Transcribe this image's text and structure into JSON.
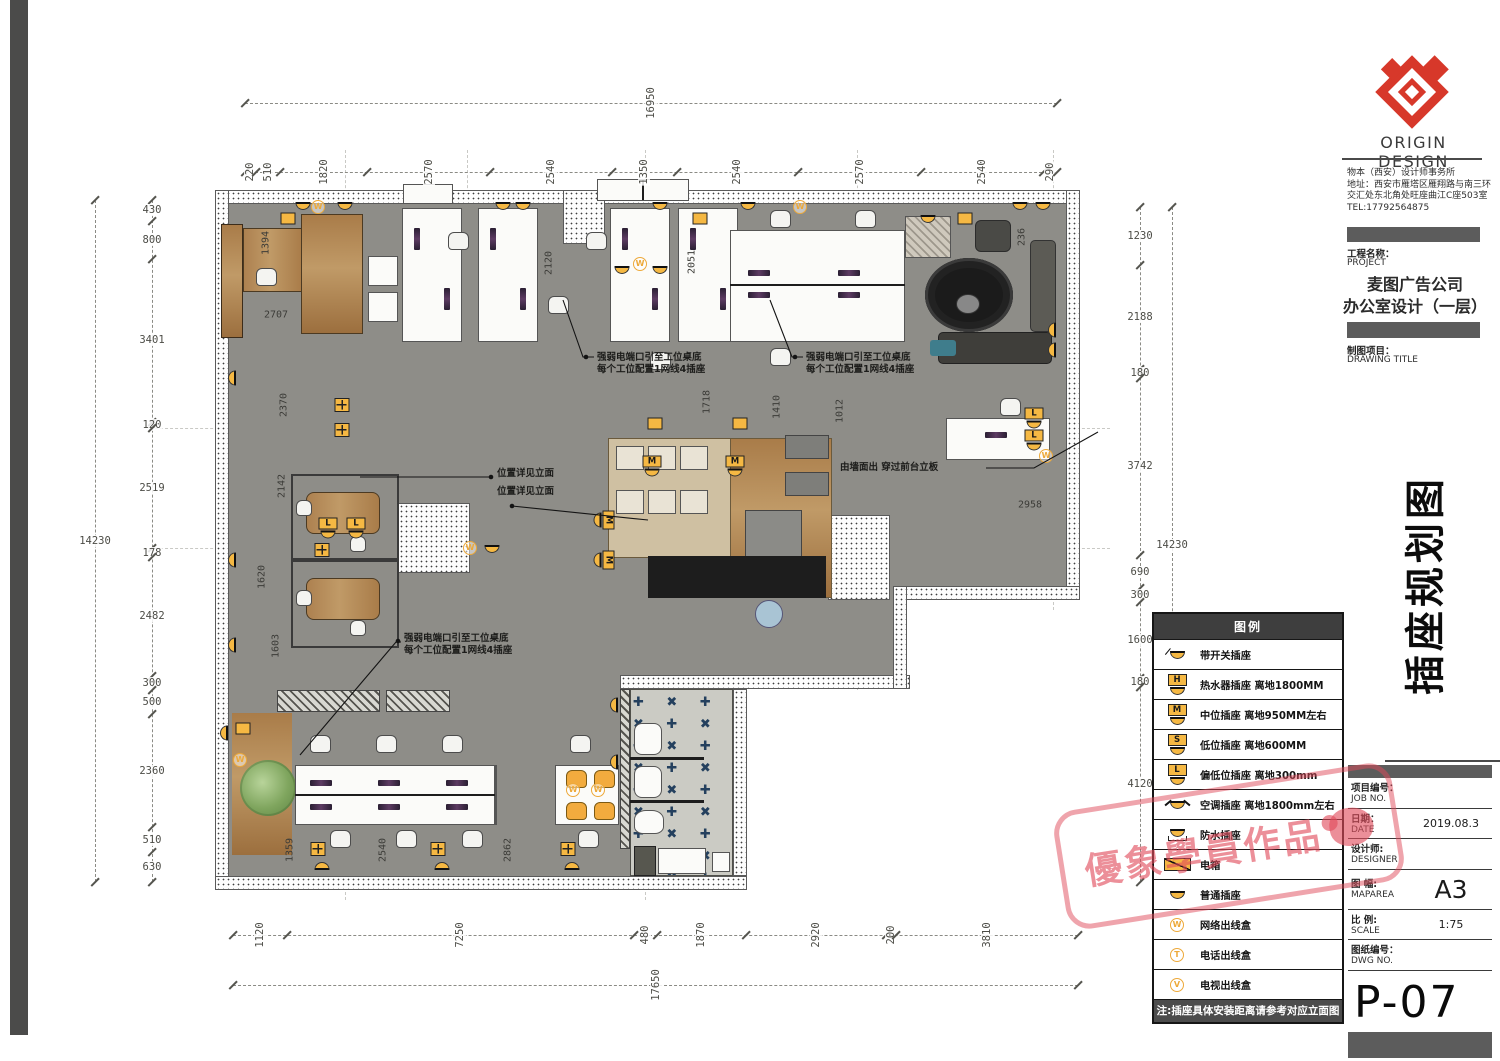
{
  "title_block": {
    "brand": "ORIGIN DESIGN",
    "company_lines": [
      "物本（西安）设计师事务所",
      "地址：西安市雁塔区雁翔路与南三环",
      "交汇处东北角处旺座曲江C座503室",
      "TEL:17792564875"
    ],
    "project_label_cn": "工程名称：",
    "project_label_en": "PROJECT",
    "project_name1": "麦图广告公司",
    "project_name2": "办公室设计（一层）",
    "drawing_label_cn": "制图项目：",
    "drawing_label_en": "DRAWING TITLE",
    "side_title": "插座规划图",
    "info_rows": [
      {
        "cn": "项目编号：",
        "en": "JOB NO.",
        "value": "",
        "big": false
      },
      {
        "cn": "日期：",
        "en": "DATE",
        "value": "2019.08.3",
        "big": false
      },
      {
        "cn": "设计师:",
        "en": "DESIGNER",
        "value": "",
        "big": false
      },
      {
        "cn": "图 幅:",
        "en": "MAPAREA",
        "value": "A3",
        "big": true
      },
      {
        "cn": "比 例:",
        "en": "SCALE",
        "value": "1:75",
        "big": false
      },
      {
        "cn": "图纸编号：",
        "en": "DWG NO.",
        "value": "",
        "big": false
      }
    ],
    "dwg_no": "P-07"
  },
  "legend": {
    "header": "图例",
    "items": [
      {
        "t": "dome-sw",
        "letter": "",
        "label": "带开关插座"
      },
      {
        "t": "H",
        "letter": "H",
        "label": "热水器插座 离地1800MM"
      },
      {
        "t": "M",
        "letter": "M",
        "label": "中位插座 离地950MM左右"
      },
      {
        "t": "S",
        "letter": "S",
        "label": "低位插座 离地600MM"
      },
      {
        "t": "L",
        "letter": "L",
        "label": "偏低位插座 离地300mm"
      },
      {
        "t": "ac",
        "letter": "",
        "label": "空调插座 离地1800mm左右"
      },
      {
        "t": "wp",
        "letter": "",
        "label": "防水插座"
      },
      {
        "t": "ebox",
        "letter": "",
        "label": "电箱"
      },
      {
        "t": "dome",
        "letter": "",
        "label": "普通插座"
      },
      {
        "t": "W",
        "letter": "W",
        "label": "网络出线盒"
      },
      {
        "t": "T",
        "letter": "T",
        "label": "电话出线盒"
      },
      {
        "t": "V",
        "letter": "V",
        "label": "电视出线盒"
      }
    ],
    "note": "注:插座具体安装距离请参考对应立面图"
  },
  "watermark": {
    "text": "優象學員作品",
    "color": "#e04a5a"
  },
  "dimensions": {
    "chains": [
      {
        "o": "h",
        "x": 245,
        "y": 103,
        "len": 812,
        "values": [
          "16950"
        ]
      },
      {
        "o": "h",
        "x": 245,
        "y": 172,
        "len": 812,
        "values": [
          "220",
          "510",
          "1820",
          "2570",
          "2540",
          "1350",
          "2540",
          "2570",
          "2540",
          "290"
        ]
      },
      {
        "o": "v",
        "x": 95,
        "y": 200,
        "len": 682,
        "values": [
          "14230"
        ]
      },
      {
        "o": "v",
        "x": 152,
        "y": 200,
        "len": 682,
        "values": [
          "430",
          "800",
          "3401",
          "120",
          "2519",
          "178",
          "2482",
          "300",
          "500",
          "2360",
          "510",
          "630"
        ]
      },
      {
        "o": "v",
        "x": 1140,
        "y": 207,
        "len": 675,
        "values": [
          "1230",
          "2188",
          "180",
          "3742",
          "690",
          "300",
          "1600",
          "180",
          "4120"
        ]
      },
      {
        "o": "v",
        "x": 1172,
        "y": 207,
        "len": 675,
        "values": [
          "14230"
        ]
      },
      {
        "o": "h",
        "x": 233,
        "y": 935,
        "len": 845,
        "values": [
          "1120",
          "7250",
          "480",
          "1870",
          "2920",
          "200",
          "3810"
        ]
      },
      {
        "o": "h",
        "x": 233,
        "y": 985,
        "len": 845,
        "values": [
          "17650"
        ]
      }
    ],
    "interior": [
      {
        "v": "1394",
        "x": 266,
        "y": 243,
        "o": "v"
      },
      {
        "v": "2707",
        "x": 276,
        "y": 315,
        "o": "h"
      },
      {
        "v": "2370",
        "x": 284,
        "y": 405,
        "o": "v"
      },
      {
        "v": "2142",
        "x": 282,
        "y": 486,
        "o": "v"
      },
      {
        "v": "1620",
        "x": 262,
        "y": 577,
        "o": "v"
      },
      {
        "v": "1603",
        "x": 276,
        "y": 646,
        "o": "v"
      },
      {
        "v": "2120",
        "x": 549,
        "y": 263,
        "o": "v"
      },
      {
        "v": "2051",
        "x": 692,
        "y": 262,
        "o": "v"
      },
      {
        "v": "236",
        "x": 1022,
        "y": 237,
        "o": "v"
      },
      {
        "v": "1718",
        "x": 707,
        "y": 402,
        "o": "v"
      },
      {
        "v": "1410",
        "x": 777,
        "y": 407,
        "o": "v"
      },
      {
        "v": "1012",
        "x": 840,
        "y": 411,
        "o": "v"
      },
      {
        "v": "2958",
        "x": 1030,
        "y": 505,
        "o": "h"
      },
      {
        "v": "1359",
        "x": 290,
        "y": 850,
        "o": "v"
      },
      {
        "v": "2540",
        "x": 383,
        "y": 850,
        "o": "v"
      },
      {
        "v": "2862",
        "x": 508,
        "y": 850,
        "o": "v"
      }
    ]
  },
  "annotations": [
    {
      "x": 597,
      "y": 352,
      "lines": [
        "强弱电端口引至工位桌底",
        "每个工位配置1网线4插座"
      ]
    },
    {
      "x": 806,
      "y": 352,
      "lines": [
        "强弱电端口引至工位桌底",
        "每个工位配置1网线4插座"
      ]
    },
    {
      "x": 497,
      "y": 468,
      "lines": [
        "位置详见立面"
      ]
    },
    {
      "x": 497,
      "y": 486,
      "lines": [
        "位置详见立面"
      ]
    },
    {
      "x": 840,
      "y": 462,
      "lines": [
        "由墙面出 穿过前台立板"
      ]
    },
    {
      "x": 404,
      "y": 633,
      "lines": [
        "强弱电端口引至工位桌底",
        "每个工位配置1网线4插座"
      ]
    }
  ],
  "plan": {
    "tile_pattern": "✚ ✖ ✚ ✖ ✚ ✖ ✚ ✖ ✚ ✖ ✚ ✖ ✚ ✖ ✚ ✖ ✚ ✖ ✚ ✖ ✚ ✖ ✚ ✖ ✚ ✖ ✚ ✖ ✚ ✖ ✚ ✖ ✚ ✖ ✚ ✖ ✚ ✖ ✚ ✖ ✚ ✖ ✚ ✖ ✚ ✖ ✚ ✖ ✚ ✖",
    "sockets": [
      {
        "t": "dome",
        "x": 303,
        "y": 206,
        "r": 0
      },
      {
        "t": "dome",
        "x": 345,
        "y": 206,
        "r": 0
      },
      {
        "t": "box",
        "x": 288,
        "y": 219,
        "r": 0
      },
      {
        "t": "W",
        "x": 318,
        "y": 207,
        "r": 0
      },
      {
        "t": "dome",
        "x": 503,
        "y": 206,
        "r": 0
      },
      {
        "t": "dome",
        "x": 523,
        "y": 206,
        "r": 0
      },
      {
        "t": "dome",
        "x": 660,
        "y": 206,
        "r": 0
      },
      {
        "t": "box",
        "x": 700,
        "y": 219,
        "r": 0
      },
      {
        "t": "dome",
        "x": 748,
        "y": 206,
        "r": 0
      },
      {
        "t": "W",
        "x": 800,
        "y": 207,
        "r": 0
      },
      {
        "t": "dome",
        "x": 928,
        "y": 219,
        "r": 0
      },
      {
        "t": "box",
        "x": 965,
        "y": 219,
        "r": 0
      },
      {
        "t": "dome",
        "x": 1020,
        "y": 206,
        "r": 0
      },
      {
        "t": "dome",
        "x": 1043,
        "y": 206,
        "r": 0
      },
      {
        "t": "dome",
        "x": 622,
        "y": 270,
        "r": 0
      },
      {
        "t": "W",
        "x": 640,
        "y": 264,
        "r": 0
      },
      {
        "t": "dome",
        "x": 660,
        "y": 270,
        "r": 0
      },
      {
        "t": "dome",
        "x": 232,
        "y": 378,
        "r": 90
      },
      {
        "t": "dome",
        "x": 232,
        "y": 560,
        "r": 90
      },
      {
        "t": "dome",
        "x": 232,
        "y": 645,
        "r": 90
      },
      {
        "t": "fbox",
        "x": 342,
        "y": 405,
        "r": 0
      },
      {
        "t": "fbox",
        "x": 342,
        "y": 430,
        "r": 0
      },
      {
        "t": "L",
        "x": 328,
        "y": 528,
        "r": 0
      },
      {
        "t": "L",
        "x": 356,
        "y": 528,
        "r": 0
      },
      {
        "t": "fbox",
        "x": 322,
        "y": 550,
        "r": 0
      },
      {
        "t": "W",
        "x": 470,
        "y": 548,
        "r": 0
      },
      {
        "t": "dome",
        "x": 492,
        "y": 549,
        "r": 0
      },
      {
        "t": "box",
        "x": 655,
        "y": 424,
        "r": 0
      },
      {
        "t": "box",
        "x": 740,
        "y": 424,
        "r": 0
      },
      {
        "t": "M",
        "x": 652,
        "y": 466,
        "r": 0
      },
      {
        "t": "M",
        "x": 735,
        "y": 466,
        "r": 0
      },
      {
        "t": "M",
        "x": 604,
        "y": 520,
        "r": 90
      },
      {
        "t": "M",
        "x": 604,
        "y": 560,
        "r": 90
      },
      {
        "t": "L",
        "x": 1034,
        "y": 418,
        "r": 0
      },
      {
        "t": "L",
        "x": 1034,
        "y": 440,
        "r": 0
      },
      {
        "t": "W",
        "x": 1046,
        "y": 456,
        "r": 0
      },
      {
        "t": "dome",
        "x": 1052,
        "y": 330,
        "r": 90
      },
      {
        "t": "dome",
        "x": 1052,
        "y": 350,
        "r": 90
      },
      {
        "t": "dome",
        "x": 224,
        "y": 733,
        "r": 90
      },
      {
        "t": "box",
        "x": 243,
        "y": 729,
        "r": 0
      },
      {
        "t": "W",
        "x": 240,
        "y": 760,
        "r": 0
      },
      {
        "t": "fbox",
        "x": 318,
        "y": 849,
        "r": 0
      },
      {
        "t": "fbox",
        "x": 438,
        "y": 849,
        "r": 0
      },
      {
        "t": "fbox",
        "x": 568,
        "y": 849,
        "r": 0
      },
      {
        "t": "dome",
        "x": 322,
        "y": 866,
        "r": 180
      },
      {
        "t": "dome",
        "x": 442,
        "y": 866,
        "r": 180
      },
      {
        "t": "dome",
        "x": 572,
        "y": 866,
        "r": 180
      },
      {
        "t": "W",
        "x": 573,
        "y": 790,
        "r": 0
      },
      {
        "t": "W",
        "x": 598,
        "y": 790,
        "r": 0
      },
      {
        "t": "dome",
        "x": 614,
        "y": 705,
        "r": 90
      },
      {
        "t": "dome",
        "x": 614,
        "y": 762,
        "r": 90
      }
    ]
  }
}
